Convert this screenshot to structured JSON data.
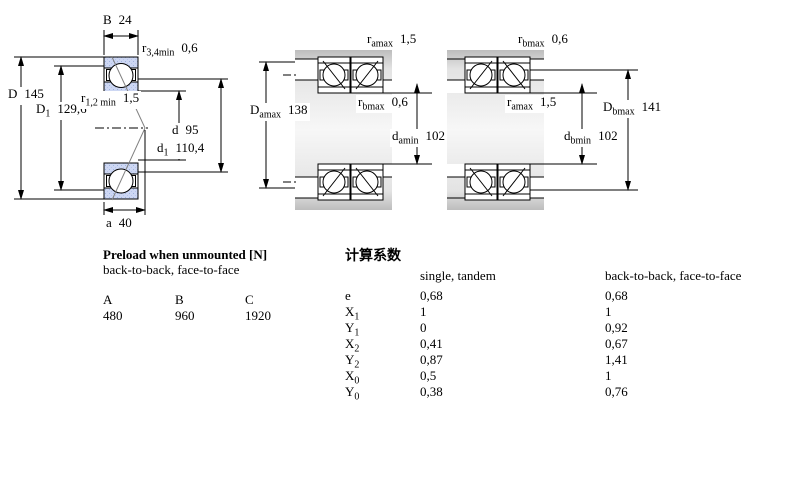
{
  "colors": {
    "ring_fill": "#cdd7f3",
    "ring_hatch_dot": "#9fb2de",
    "housing_gray": "#c9c9c9",
    "line_black": "#000000",
    "contact_line_gray": "#808080"
  },
  "drawings": {
    "left": {
      "B": {
        "base": "B",
        "sub": "",
        "value": "24"
      },
      "r34": {
        "base": "r",
        "sub": "3,4min",
        "value": "0,6"
      },
      "D": {
        "base": "D",
        "sub": "",
        "value": "145"
      },
      "D1": {
        "base": "D",
        "sub": "1",
        "value": "129,6"
      },
      "r12": {
        "base": "r",
        "sub": "1,2 min",
        "value": "1,5"
      },
      "d": {
        "base": "d",
        "sub": "",
        "value": "95"
      },
      "d1": {
        "base": "d",
        "sub": "1",
        "value": "110,4"
      },
      "a": {
        "base": "a",
        "sub": "",
        "value": "40"
      }
    },
    "middle": {
      "r_amax": {
        "base": "r",
        "sub": "amax",
        "value": "1,5"
      },
      "r_bmax": {
        "base": "r",
        "sub": "bmax",
        "value": "0,6"
      },
      "Damax": {
        "base": "D",
        "sub": "amax",
        "value": "138"
      },
      "damin": {
        "base": "d",
        "sub": "amin",
        "value": "102"
      }
    },
    "right": {
      "r_bmax": {
        "base": "r",
        "sub": "bmax",
        "value": "0,6"
      },
      "r_amax": {
        "base": "r",
        "sub": "amax",
        "value": "1,5"
      },
      "Dbmax": {
        "base": "D",
        "sub": "bmax",
        "value": "141"
      },
      "dbmin": {
        "base": "d",
        "sub": "bmin",
        "value": "102"
      }
    }
  },
  "preload": {
    "title": "Preload when unmounted [N]",
    "subtitle": "back-to-back, face-to-face",
    "columns": [
      "A",
      "B",
      "C"
    ],
    "values": [
      "480",
      "960",
      "1920"
    ]
  },
  "factors": {
    "title": "计算系数",
    "col_single": "single, tandem",
    "col_paired": "back-to-back, face-to-face",
    "rows": [
      {
        "base": "e",
        "sub": "",
        "single": "0,68",
        "paired": "0,68"
      },
      {
        "base": "X",
        "sub": "1",
        "single": "1",
        "paired": "1"
      },
      {
        "base": "Y",
        "sub": "1",
        "single": "0",
        "paired": "0,92"
      },
      {
        "base": "X",
        "sub": "2",
        "single": "0,41",
        "paired": "0,67"
      },
      {
        "base": "Y",
        "sub": "2",
        "single": "0,87",
        "paired": "1,41"
      },
      {
        "base": "X",
        "sub": "0",
        "single": "0,5",
        "paired": "1"
      },
      {
        "base": "Y",
        "sub": "0",
        "single": "0,38",
        "paired": "0,76"
      }
    ]
  }
}
